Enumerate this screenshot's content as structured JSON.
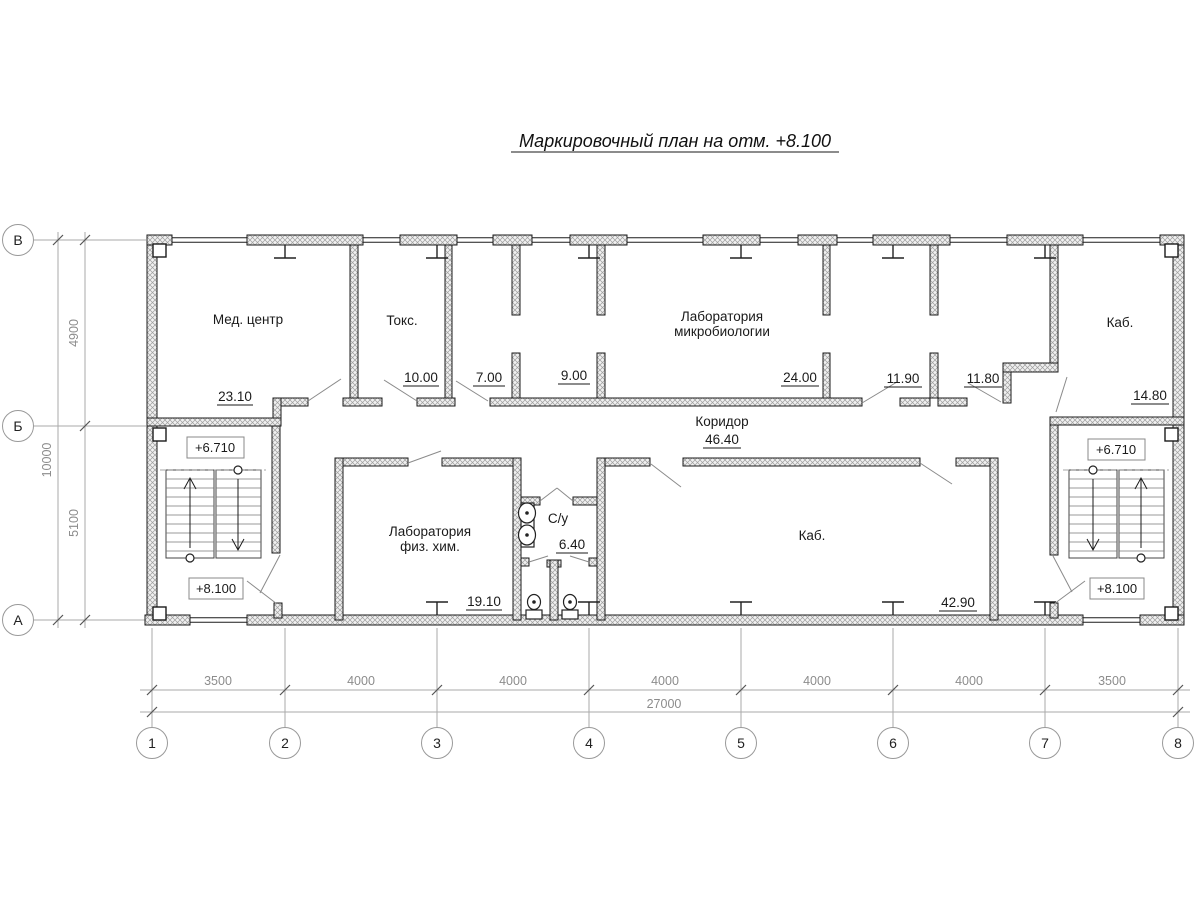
{
  "title": "Маркировочный план на отм. +8.100",
  "grid": {
    "row_axes": [
      "В",
      "Б",
      "А"
    ],
    "col_axes": [
      "1",
      "2",
      "3",
      "4",
      "5",
      "6",
      "7",
      "8"
    ]
  },
  "dimensions": {
    "vertical": {
      "segments": [
        "4900",
        "5100"
      ],
      "total": "10000"
    },
    "horizontal": {
      "segments": [
        "3500",
        "4000",
        "4000",
        "4000",
        "4000",
        "4000",
        "3500"
      ],
      "total": "27000"
    }
  },
  "rooms": {
    "med_center": {
      "name": "Мед. центр",
      "area": "23.10"
    },
    "toks": {
      "name": "Токс.",
      "area": "10.00"
    },
    "room_7": {
      "area": "7.00"
    },
    "room_9": {
      "area": "9.00"
    },
    "lab_micro": {
      "name_line1": "Лаборатория",
      "name_line2": "микробиологии",
      "area": "24.00"
    },
    "room_11_90": {
      "area": "11.90"
    },
    "room_11_80": {
      "area": "11.80"
    },
    "kab_top": {
      "name": "Каб.",
      "area": "14.80"
    },
    "corridor": {
      "name": "Коридор",
      "area": "46.40"
    },
    "lab_fizhim": {
      "name_line1": "Лаборатория",
      "name_line2": "физ. хим.",
      "area": "19.10"
    },
    "su": {
      "name": "С/у",
      "area": "6.40"
    },
    "kab_bottom": {
      "name": "Каб.",
      "area": "42.90"
    }
  },
  "elevations": {
    "left_upper": "+6.710",
    "left_lower": "+8.100",
    "right_upper": "+6.710",
    "right_lower": "+8.100"
  },
  "icons": {
    "sink": "sink-icon",
    "toilet": "toilet-icon",
    "stair_up": "arrow-up-icon",
    "stair_down": "arrow-down-icon"
  },
  "colors": {
    "wall_line": "#1b1b1b",
    "hatch": "#9e9e9e",
    "dim_line": "#aaaaaa",
    "dim_text": "#8c8c8c",
    "text": "#1a1a1a"
  }
}
